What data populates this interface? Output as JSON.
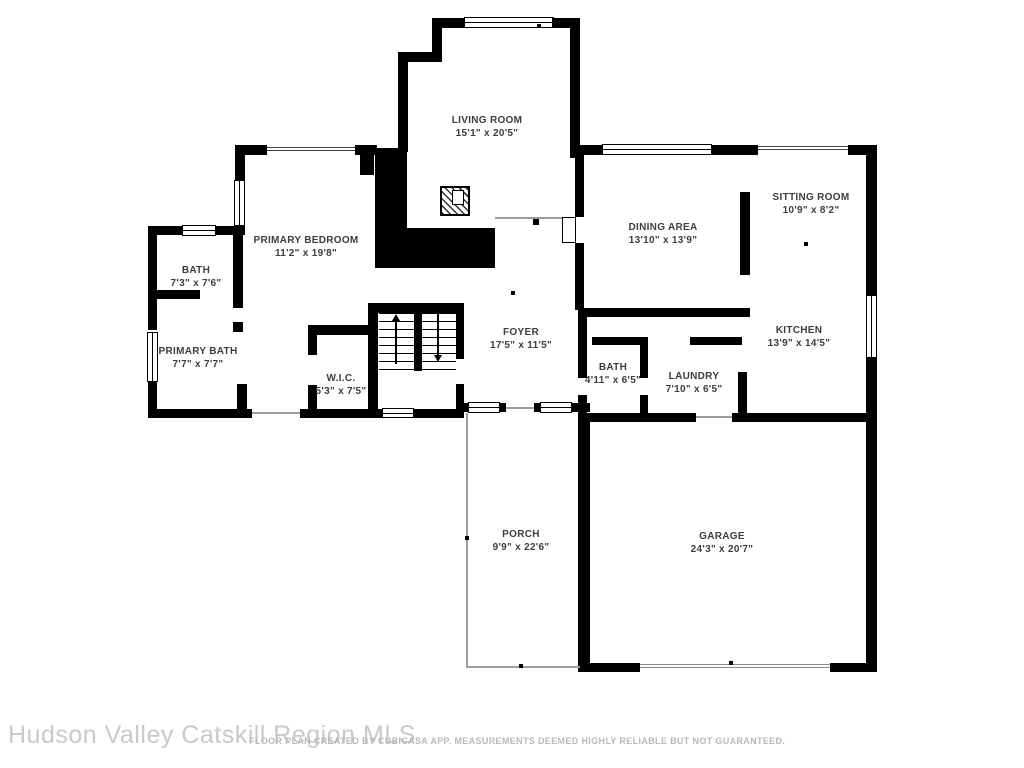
{
  "floor_plan": {
    "rooms": {
      "living_room": {
        "name": "LIVING ROOM",
        "dims": "15'1\" x 20'5\""
      },
      "primary_bedroom": {
        "name": "PRIMARY BEDROOM",
        "dims": "11'2\" x 19'8\""
      },
      "bath_upper": {
        "name": "BATH",
        "dims": "7'3\" x 7'6\""
      },
      "primary_bath": {
        "name": "PRIMARY BATH",
        "dims": "7'7\" x 7'7\""
      },
      "wic": {
        "name": "W.I.C.",
        "dims": "5'3\" x 7'5\""
      },
      "foyer": {
        "name": "FOYER",
        "dims": "17'5\" x 11'5\""
      },
      "dining_area": {
        "name": "DINING AREA",
        "dims": "13'10\" x 13'9\""
      },
      "sitting_room": {
        "name": "SITTING ROOM",
        "dims": "10'9\" x 8'2\""
      },
      "kitchen": {
        "name": "KITCHEN",
        "dims": "13'9\" x 14'5\""
      },
      "bath_lower": {
        "name": "BATH",
        "dims": "4'11\" x 6'5\""
      },
      "laundry": {
        "name": "LAUNDRY",
        "dims": "7'10\" x 6'5\""
      },
      "porch": {
        "name": "PORCH",
        "dims": "9'9\" x 22'6\""
      },
      "garage": {
        "name": "GARAGE",
        "dims": "24'3\" x 20'7\""
      }
    },
    "watermark": "Hudson Valley Catskill Region MLS",
    "disclaimer": "FLOOR PLAN CREATED BY CUBICASA APP. MEASUREMENTS DEEMED HIGHLY RELIABLE BUT NOT GUARANTEED.",
    "colors": {
      "wall": "#000000",
      "background": "#ffffff",
      "label_text": "#3d3d3d",
      "watermark_text": "#c9c9c9",
      "disclaimer_text": "#b9b9b9"
    }
  }
}
